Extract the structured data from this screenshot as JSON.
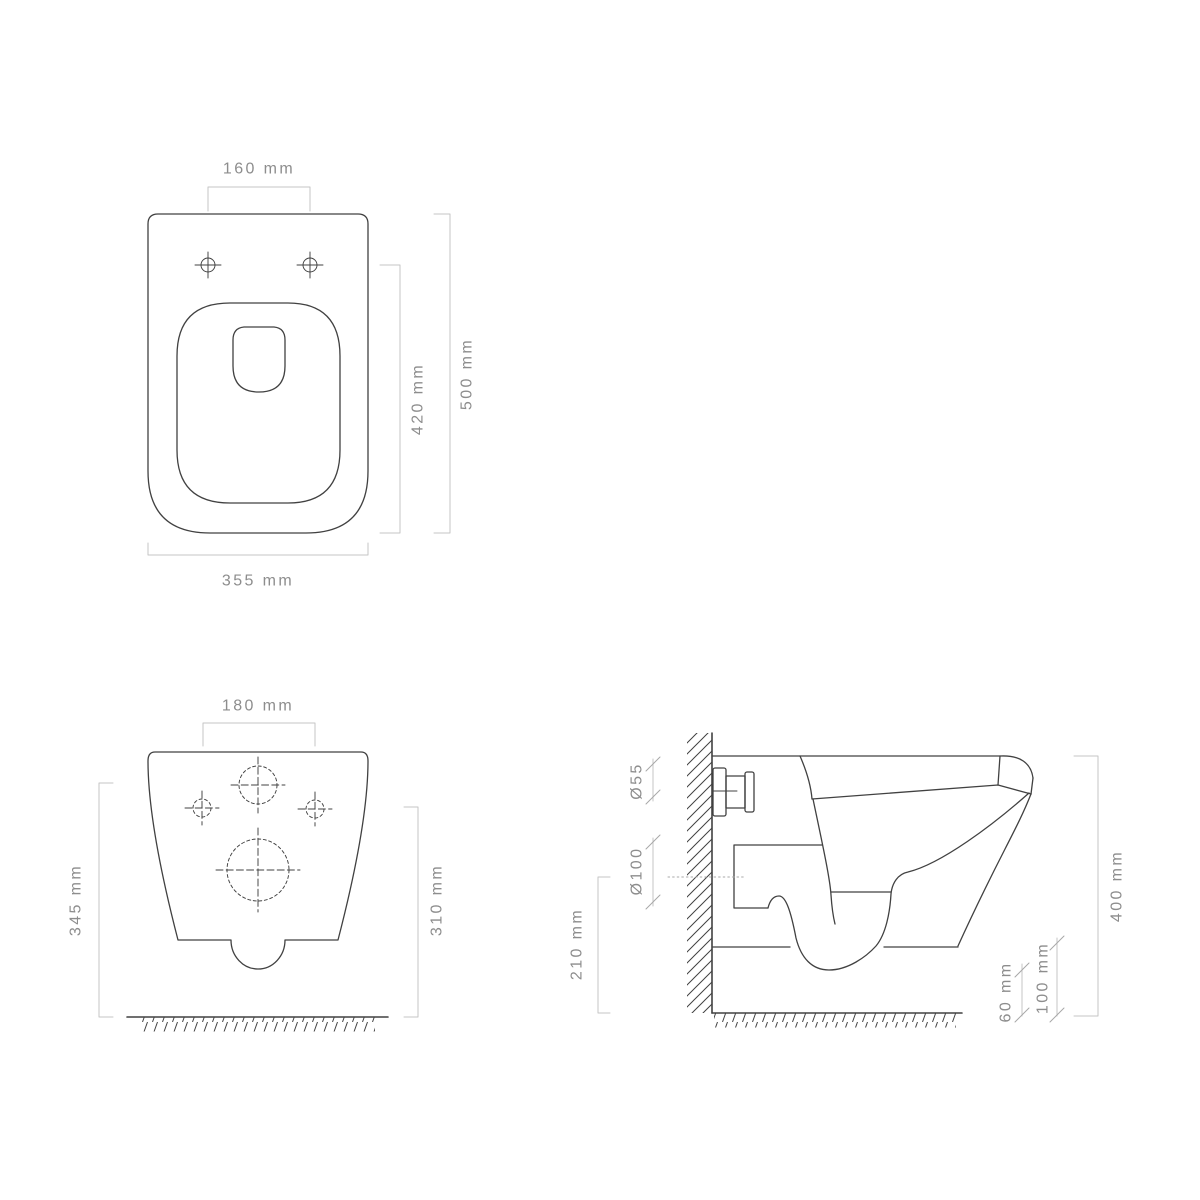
{
  "colors": {
    "line": "#414141",
    "dim": "#c4c4c4",
    "tick": "#a8a8a8",
    "text": "#8d8d8d",
    "background": "#ffffff"
  },
  "top_view": {
    "hole_spacing": "160 mm",
    "overall_depth": "500 mm",
    "hole_depth": "420 mm",
    "overall_width": "355 mm"
  },
  "front_view": {
    "hole_spacing": "180 mm",
    "inlet_axis_height": "345 mm",
    "fixing_hole_height": "310 mm"
  },
  "side_view": {
    "inlet_diameter": "Ø55",
    "outlet_diameter": "Ø100",
    "outlet_axis_height": "210 mm",
    "overall_height": "400 mm",
    "trap_clearance": "60 mm",
    "front_clearance": "100 mm"
  }
}
